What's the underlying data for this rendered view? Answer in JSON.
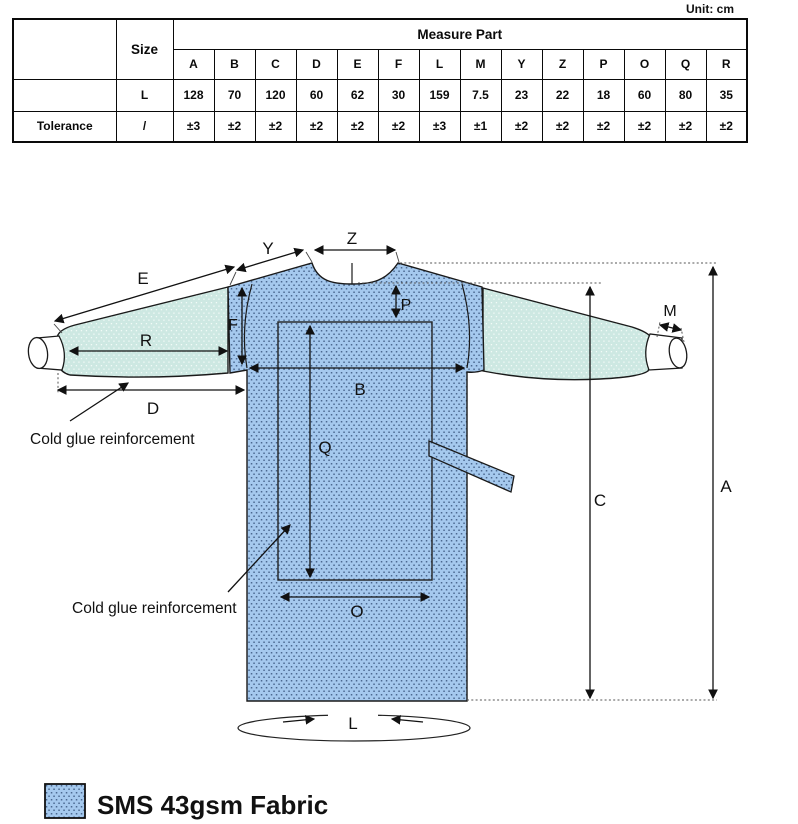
{
  "unit_label": "Unit: cm",
  "table": {
    "size_header": "Size",
    "measure_part_header": "Measure Part",
    "tolerance_label": "Tolerance",
    "size_value": "L",
    "tolerance_size_value": "/",
    "columns": [
      "A",
      "B",
      "C",
      "D",
      "E",
      "F",
      "L",
      "M",
      "Y",
      "Z",
      "P",
      "O",
      "Q",
      "R"
    ],
    "values": [
      "128",
      "70",
      "120",
      "60",
      "62",
      "30",
      "159",
      "7.5",
      "23",
      "22",
      "18",
      "60",
      "80",
      "35"
    ],
    "tolerances": [
      "±3",
      "±2",
      "±2",
      "±2",
      "±2",
      "±2",
      "±3",
      "±1",
      "±2",
      "±2",
      "±2",
      "±2",
      "±2",
      "±2"
    ]
  },
  "diagram": {
    "labels": {
      "A": "A",
      "B": "B",
      "C": "C",
      "D": "D",
      "E": "E",
      "F": "F",
      "L": "L",
      "M": "M",
      "Y": "Y",
      "Z": "Z",
      "P": "P",
      "O": "O",
      "Q": "Q",
      "R": "R"
    },
    "annotations": {
      "cold_glue_1": "Cold glue reinforcement",
      "cold_glue_2": "Cold glue reinforcement"
    },
    "colors": {
      "body_fabric": "#a5c9ee",
      "body_dot": "#4a6890",
      "sleeve_fabric": "#cde8e2",
      "sleeve_dot": "#f2faf7",
      "outline": "#1a1a1a"
    }
  },
  "legend": {
    "label": "SMS 43gsm Fabric"
  }
}
